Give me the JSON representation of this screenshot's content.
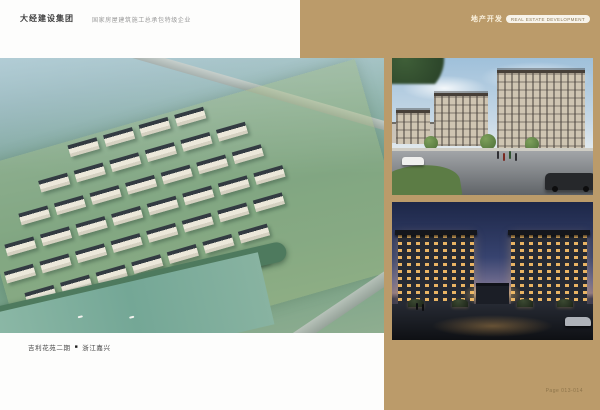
{
  "header": {
    "company_name": "大经建设集团",
    "company_tagline": "国家房屋建筑施工总承包特级企业",
    "section_label": "地产开发",
    "section_badge": "REAL ESTATE DEVELOPMENT"
  },
  "caption": {
    "project_name": "吉利花苑二期",
    "separator": "■",
    "location": "浙江嘉兴"
  },
  "footer": {
    "page_number": "Page 013-014"
  },
  "colors": {
    "accent_tan": "#bb9b6a",
    "page_background": "#fdfdfc",
    "caption_text": "#474747",
    "page_number_text": "#8d744a"
  },
  "photos": [
    {
      "name": "aerial-masterplan-rendering"
    },
    {
      "name": "street-elevation-rendering"
    },
    {
      "name": "entrance-night-rendering"
    }
  ]
}
